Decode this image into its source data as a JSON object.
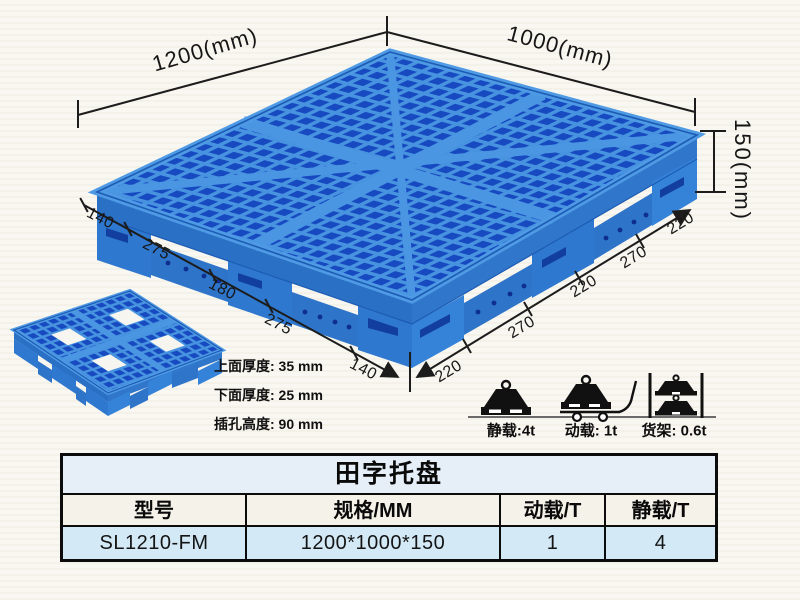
{
  "dimensions": {
    "top_left": "1200(mm)",
    "top_right": "1000(mm)",
    "height": "150(mm)",
    "left_edge": [
      "140",
      "275",
      "180",
      "275",
      "140"
    ],
    "right_edge": [
      "220",
      "270",
      "220",
      "270",
      "220"
    ]
  },
  "thickness_notes": [
    "上面厚度: 35 mm",
    "下面厚度: 25 mm",
    "插孔高度: 90 mm"
  ],
  "load_ratings": [
    {
      "icon": "static-load-icon",
      "label": "静载:4t"
    },
    {
      "icon": "dynamic-load-icon",
      "label": "动载: 1t"
    },
    {
      "icon": "rack-load-icon",
      "label": "货架: 0.6t"
    }
  ],
  "table": {
    "title": "田字托盘",
    "headers": [
      "型号",
      "规格/MM",
      "动载/T",
      "静载/T"
    ],
    "row": [
      "SL1210-FM",
      "1200*1000*150",
      "1",
      "4"
    ]
  },
  "colors": {
    "pallet_blue": "#2e7bd0",
    "pallet_rib_light": "#4f9ae4",
    "pallet_hole_dark": "#1749c0",
    "pallet_side": "#2a70c5",
    "line_color": "#1c1c1c",
    "table_title_bg": "#e6eff7",
    "table_header_bg": "#f5f2e9",
    "table_row_bg": "#d3e9f6"
  }
}
